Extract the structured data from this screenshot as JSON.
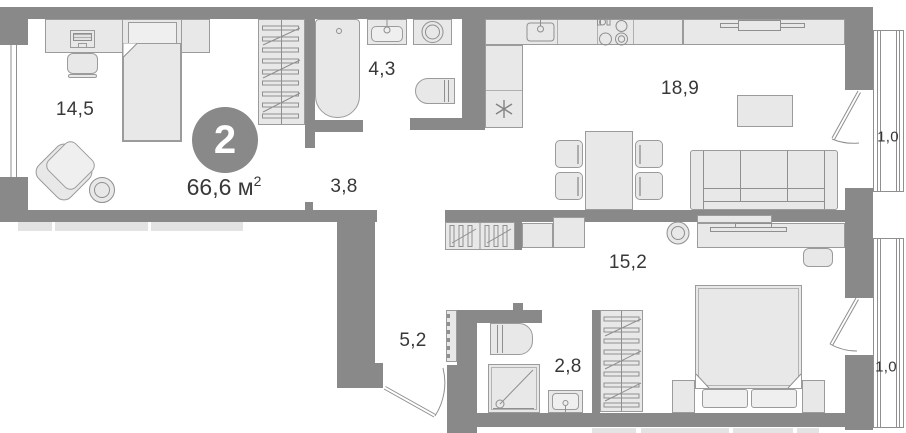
{
  "floor_plan": {
    "badge": {
      "rooms_count": "2"
    },
    "total_area": {
      "value": "66,6 м",
      "sup": "2"
    },
    "room_labels": {
      "living_room": "14,5",
      "bathroom": "4,3",
      "hallway": "3,8",
      "kitchen_living": "18,9",
      "bedroom": "15,2",
      "corridor": "5,2",
      "shower_room": "2,8",
      "balcony_top": "1,0",
      "balcony_bottom": "1,0"
    },
    "colors": {
      "wall": "#898989",
      "furniture_fill": "#e8e8e8",
      "furniture_stroke": "#9b9b9b",
      "text": "#383838",
      "badge_fill": "#898989",
      "badge_text": "#ffffff"
    },
    "symbols": {
      "fridge": "snowflake-icon",
      "doors": "swing-arc",
      "wardrobes": "hanger-rail"
    }
  }
}
